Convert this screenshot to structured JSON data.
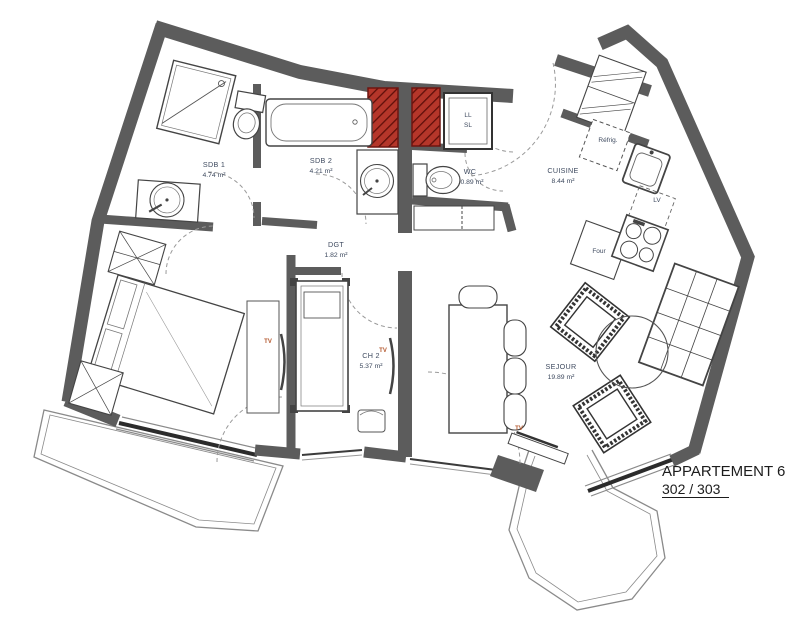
{
  "header": {
    "title": "APPARTEMENT 6",
    "subtitle": "302 / 303"
  },
  "rooms": {
    "sdb1": {
      "name": "SDB 1",
      "area": "4.74 m²"
    },
    "sdb2": {
      "name": "SDB 2",
      "area": "4.21 m²"
    },
    "wc": {
      "name": "WC",
      "area": "0.89 m²"
    },
    "cuisine": {
      "name": "CUISINE",
      "area": "8.44 m²"
    },
    "dgt": {
      "name": "DGT",
      "area": "1.82 m²"
    },
    "ch2": {
      "name": "CH 2",
      "area": "5.37 m²"
    },
    "sejour": {
      "name": "SEJOUR",
      "area": "19.89 m²"
    }
  },
  "appliances": {
    "washer": "LL",
    "dryer": "SL",
    "fridge": "Réfrig.",
    "dishwasher": "LV",
    "oven": "Four",
    "tv": "TV"
  },
  "colors": {
    "wall": "#5c5c5c",
    "shaft_red": "#b5362a",
    "shaft_hatch": "#5f0f0a",
    "label": "#3e4a5f",
    "tv_label": "#b3562b",
    "furniture_line": "#444444"
  }
}
